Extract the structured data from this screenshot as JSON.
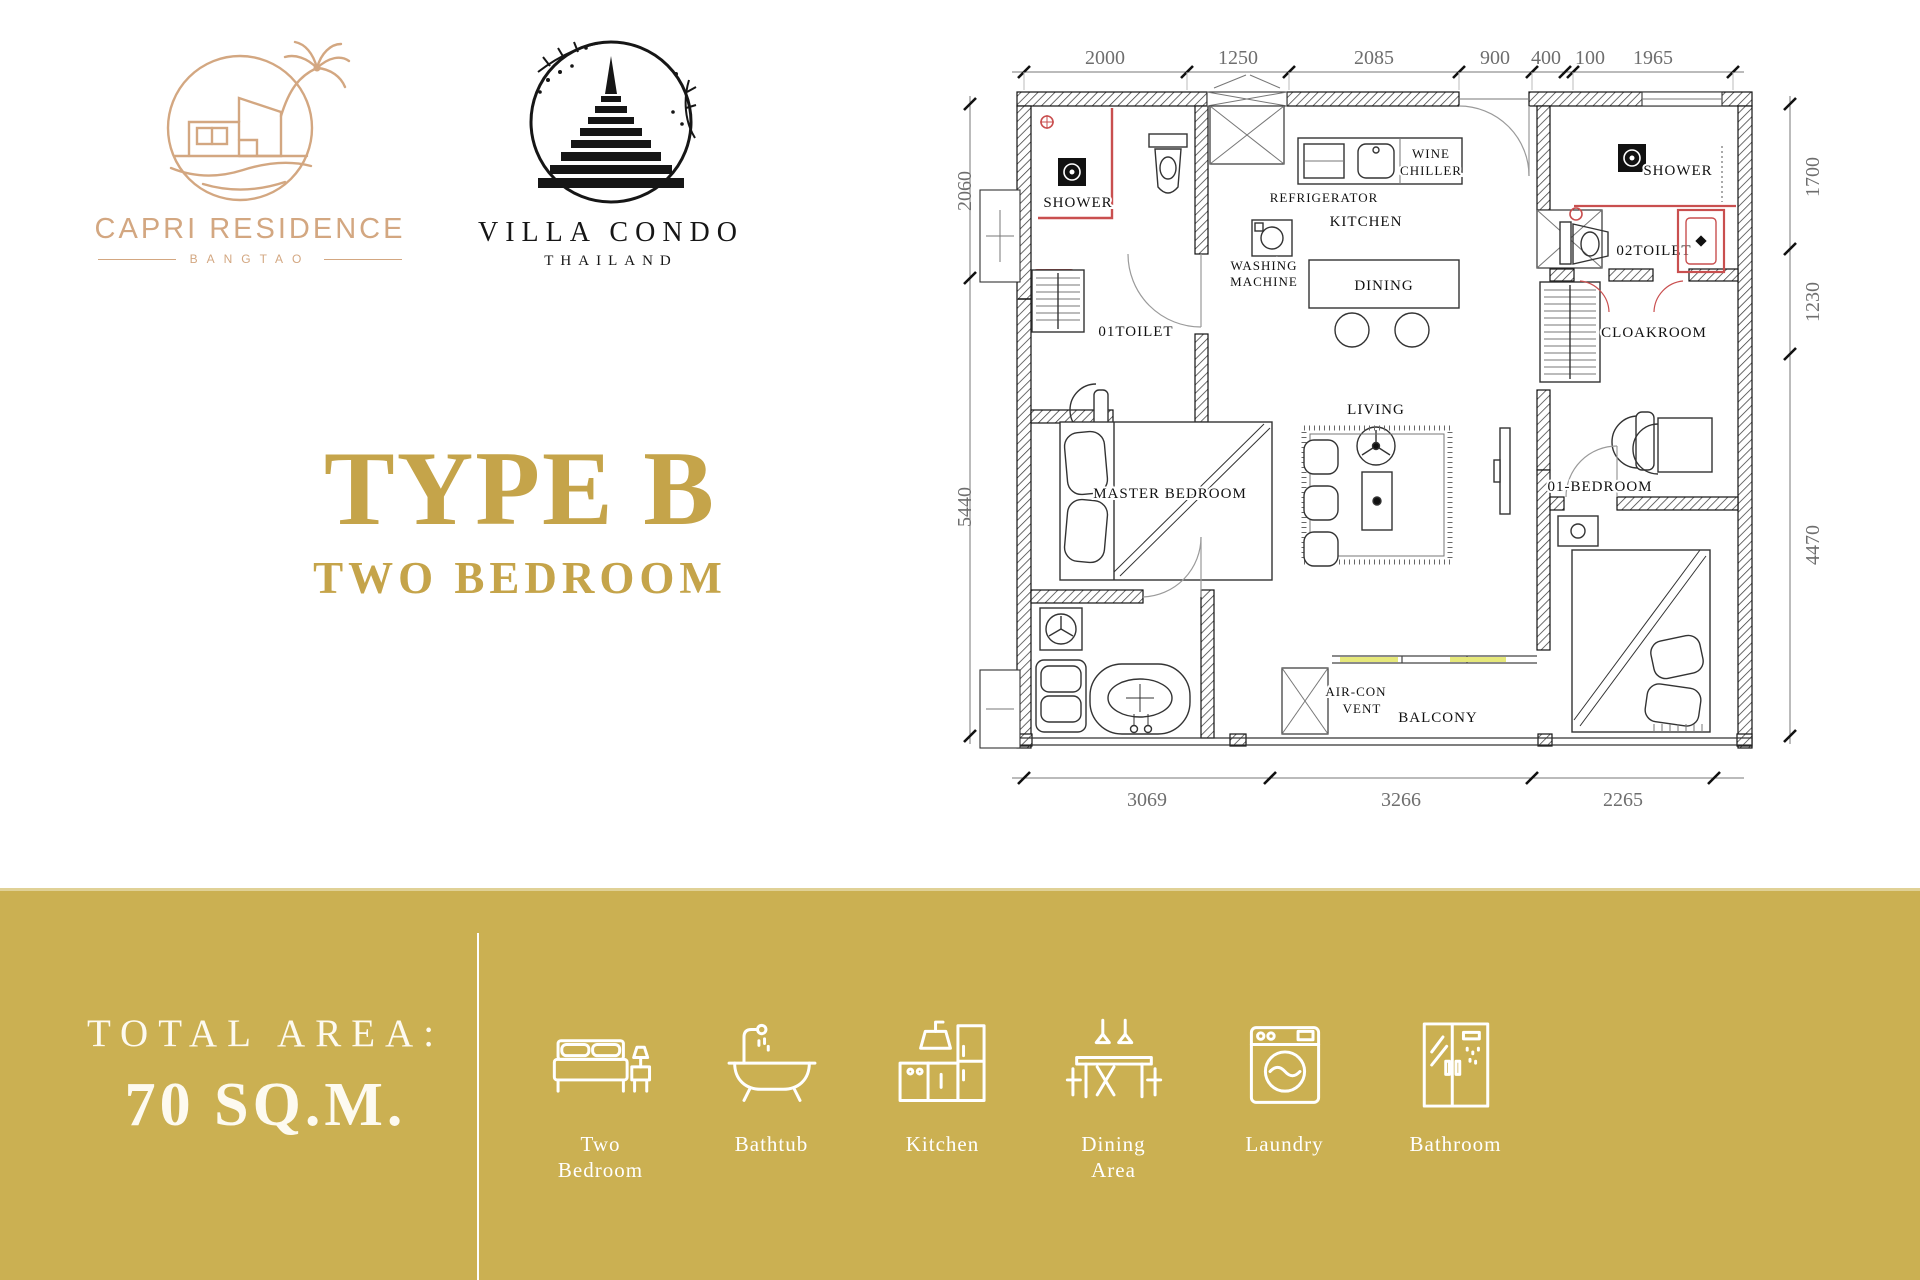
{
  "branding": {
    "capri": {
      "name": "CAPRI RESIDENCE",
      "subtitle": "BANGTAO"
    },
    "villa": {
      "name": "VILLA CONDO",
      "subtitle": "THAILAND"
    }
  },
  "unit": {
    "type_title": "TYPE B",
    "type_subtitle": "TWO BEDROOM"
  },
  "floorplan": {
    "dims_top": [
      "2000",
      "1250",
      "2085",
      "900",
      "400",
      "100",
      "1965"
    ],
    "dims_left": [
      "2060",
      "5440"
    ],
    "dims_right": [
      "1700",
      "1230",
      "4470"
    ],
    "dims_bottom": [
      "3069",
      "3266",
      "2265"
    ],
    "labels": {
      "shower1": "SHOWER",
      "toilet1": "01TOILET",
      "washing1": "WASHING",
      "washing2": "MACHINE",
      "refrigerator": "REFRIGERATOR",
      "kitchen": "KITCHEN",
      "wine1": "WINE",
      "wine2": "CHILLER",
      "dining": "DINING",
      "living": "LIVING",
      "cloakroom": "CLOAKROOM",
      "shower2": "SHOWER",
      "toilet2": "02TOILET",
      "master": "MASTER BEDROOM",
      "bedroom01": "01-BEDROOM",
      "aircon1": "AIR-CON",
      "aircon2": "VENT",
      "balcony": "BALCONY"
    }
  },
  "footer": {
    "total_area_label": "TOTAL AREA:",
    "total_area_value": "70 SQ.M.",
    "features": [
      {
        "label": "Two Bedroom",
        "icon": "bed-icon"
      },
      {
        "label": "Bathtub",
        "icon": "bathtub-icon"
      },
      {
        "label": "Kitchen",
        "icon": "kitchen-icon"
      },
      {
        "label": "Dining Area",
        "icon": "dining-icon"
      },
      {
        "label": "Laundry",
        "icon": "laundry-icon"
      },
      {
        "label": "Bathroom",
        "icon": "bathroom-icon"
      }
    ]
  },
  "colors": {
    "gold_band": "#cbb052",
    "gold_text": "#c5a44a",
    "logo_tan": "#d3a781",
    "ink": "#161616",
    "plan_red": "#c94f4f",
    "balcony_yellow": "#e6e87a"
  }
}
